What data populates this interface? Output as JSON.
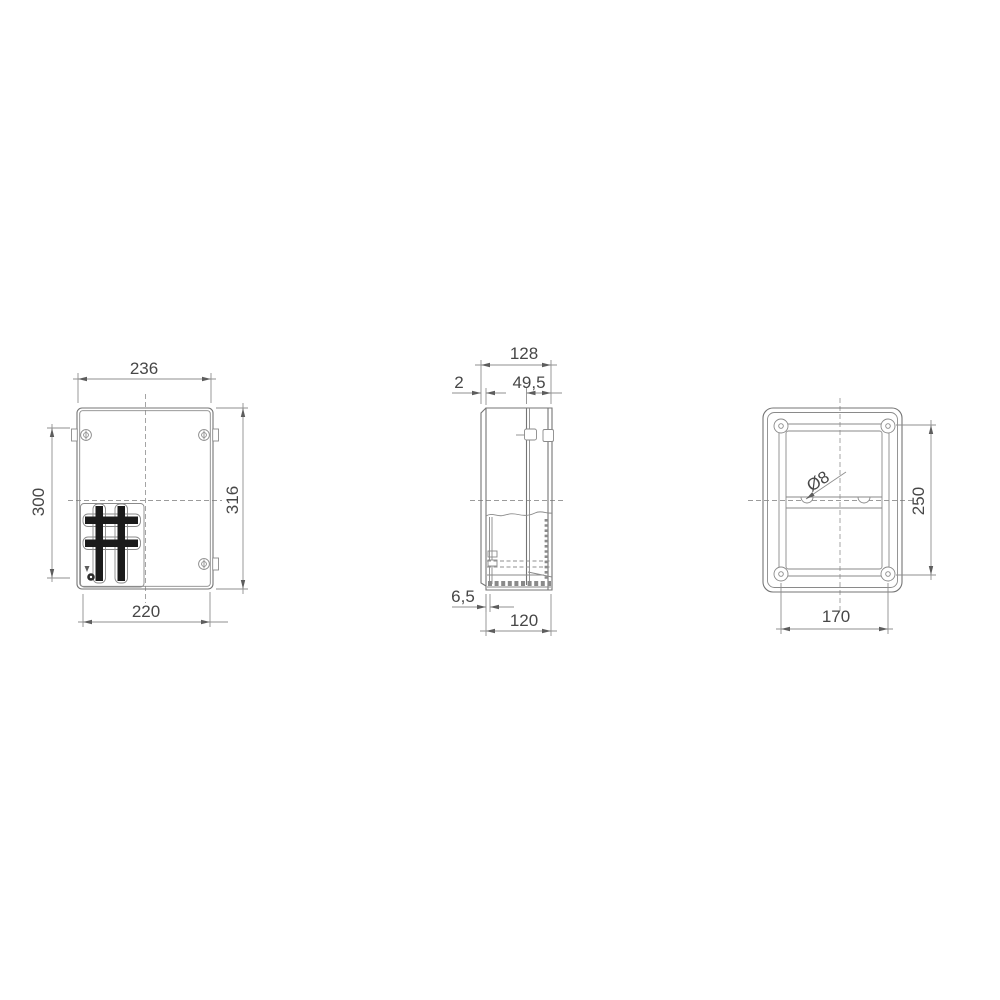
{
  "drawing": {
    "type": "technical-drawing",
    "subject": "plastic enclosure box, three orthographic views",
    "colors": {
      "background": "#ffffff",
      "line": "#757575",
      "dimension_text": "#474747",
      "rib_fill": "#1b1b1b"
    }
  },
  "views": {
    "front": {
      "label": "front-view",
      "dims": {
        "width_top": "236",
        "height_left": "300",
        "height_right": "316",
        "width_bottom": "220"
      }
    },
    "side": {
      "label": "side-view",
      "dims": {
        "depth_top": "128",
        "lid_gap": "2",
        "cover_depth": "49,5",
        "base_offset": "6,5",
        "depth_bottom": "120"
      }
    },
    "back": {
      "label": "back-view",
      "dims": {
        "hole_diameter": "Ø8",
        "hole_spacing_vertical": "250",
        "hole_spacing_horizontal": "170"
      }
    }
  }
}
